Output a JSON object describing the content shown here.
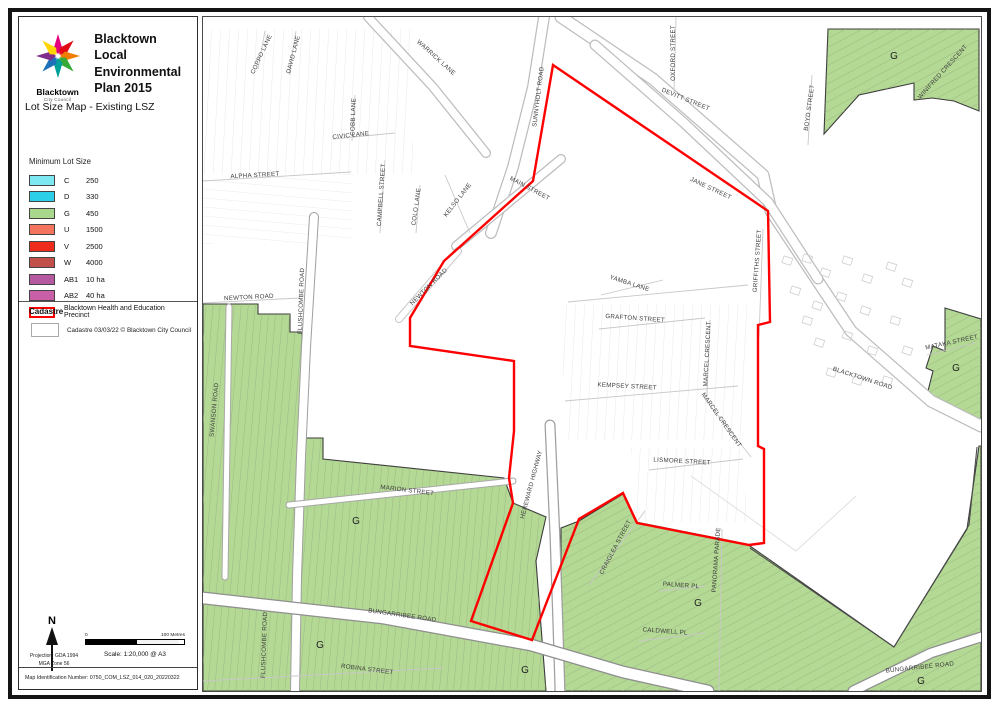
{
  "panel": {
    "logo": {
      "org": "Blacktown",
      "org_sub": "City Council"
    },
    "title": "Blacktown Local Environmental Plan 2015",
    "subtitle": "Lot Size Map - Existing LSZ",
    "legend": {
      "heading": "Minimum Lot Size",
      "items": [
        {
          "code": "C",
          "value": "250",
          "color": "#7EE8F2"
        },
        {
          "code": "D",
          "value": "330",
          "color": "#2BCFE8"
        },
        {
          "code": "G",
          "value": "450",
          "color": "#A9D88C"
        },
        {
          "code": "U",
          "value": "1500",
          "color": "#F4745E"
        },
        {
          "code": "V",
          "value": "2500",
          "color": "#EF2B1E"
        },
        {
          "code": "W",
          "value": "4000",
          "color": "#C1504B"
        },
        {
          "code": "AB1",
          "value": "10 ha",
          "color": "#B55AA0"
        },
        {
          "code": "AB2",
          "value": "40 ha",
          "color": "#C95FA6"
        }
      ],
      "precinct": {
        "label": "Blacktown Health and Education Precinct",
        "color": "#FF0000"
      }
    },
    "cadastre": {
      "heading": "Cadastre",
      "label": "Cadastre 03/03/22 © Blacktown City Council"
    },
    "north_label": "N",
    "scalebar": {
      "left": "0",
      "right": "100 Metres"
    },
    "scale_text": "Scale: 1:20,000 @ A3",
    "projection_line1": "Projection: GDA 1994",
    "projection_line2": "MGA Zone 56",
    "map_id": "Map Identification Number: 0750_COM_LSZ_014_020_20220322"
  },
  "map": {
    "zone_letter": "G",
    "colors": {
      "precinct_red": "#FF0000",
      "zone_g_fill": "#B3D994"
    },
    "labels": [
      {
        "text": "COPPO LANE"
      },
      {
        "text": "DAVID LANE"
      },
      {
        "text": "WARRICK LANE"
      },
      {
        "text": "COBB LANE"
      },
      {
        "text": "CIVIC LANE"
      },
      {
        "text": "ALPHA STREET"
      },
      {
        "text": "CAMPBELL STREET"
      },
      {
        "text": "COLO LANE"
      },
      {
        "text": "KELSO LANE"
      },
      {
        "text": "SUNNYHOLT ROAD"
      },
      {
        "text": "MAIN STREET"
      },
      {
        "text": "OXFORD STREET"
      },
      {
        "text": "DEVITT STREET"
      },
      {
        "text": "JANE STREET"
      },
      {
        "text": "BOYD STREET"
      },
      {
        "text": "WINIFRED CRESCENT"
      },
      {
        "text": "GRIFFITHS STREET"
      },
      {
        "text": "YAMBA LANE"
      },
      {
        "text": "GRAFTON STREET"
      },
      {
        "text": "MARCEL CRESCENT"
      },
      {
        "text": "KEMPSEY STREET"
      },
      {
        "text": "MARCEL CRESCENT"
      },
      {
        "text": "LISMORE STREET"
      },
      {
        "text": "NEWTON ROAD"
      },
      {
        "text": "FLUSHCOMBE ROAD"
      },
      {
        "text": "NEWTON ROAD"
      },
      {
        "text": "SWANSON ROAD"
      },
      {
        "text": "MARION STREET"
      },
      {
        "text": "HEREWARD HIGHWAY"
      },
      {
        "text": "BUNGARRIBEE ROAD"
      },
      {
        "text": "ROBINA STREET"
      },
      {
        "text": "FLUSHCOMBE ROAD"
      },
      {
        "text": "CRAIGLEA STREET"
      },
      {
        "text": "PANORAMA PARADE"
      },
      {
        "text": "PALMER PL"
      },
      {
        "text": "CALDWELL PL"
      },
      {
        "text": "BUNGARRIBEE ROAD"
      },
      {
        "text": "MATAKA STREET"
      },
      {
        "text": "BLACKTOWN ROAD"
      }
    ]
  }
}
